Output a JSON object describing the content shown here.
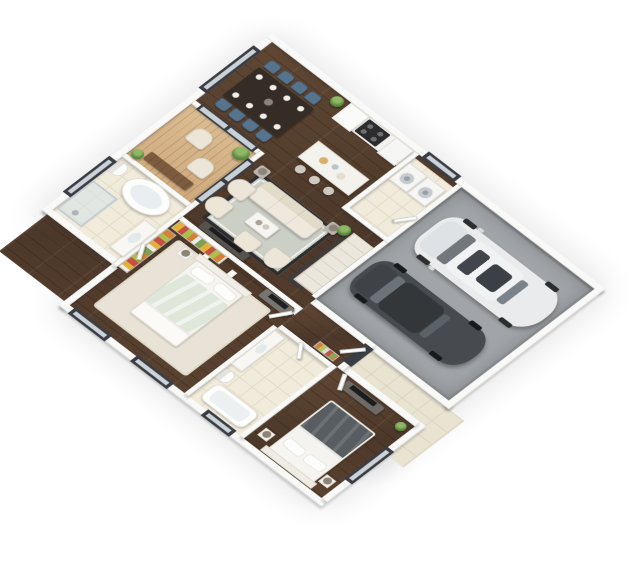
{
  "scene": {
    "type": "isometric-3d-floor-plan",
    "background_color": "#ffffff",
    "rooms": {
      "dining": {
        "name": "Dining area",
        "floor": "dark hardwood",
        "items": [
          "dark rectangular dining table",
          "8 blue upholstered chairs",
          "white place settings",
          "potted plant"
        ]
      },
      "kitchen": {
        "name": "Kitchen",
        "floor": "dark hardwood",
        "items": [
          "white wall counter",
          "black cooktop range",
          "refrigerator",
          "tall cabinet",
          "island with stone top",
          "3 bar stools"
        ]
      },
      "laundry": {
        "name": "Laundry room",
        "floor": "cream tile",
        "items": [
          "washer",
          "dryer"
        ]
      },
      "garage": {
        "name": "Two-car garage",
        "floor": "gray concrete",
        "items": [
          "white SUV",
          "dark gray sedan"
        ]
      },
      "deck": {
        "name": "Wood deck",
        "floor": "light wood planks",
        "items": [
          "2 lounge chairs",
          "low wooden table",
          "2 potted plants"
        ]
      },
      "living": {
        "name": "Living room",
        "floor": "dark hardwood",
        "items": [
          "cream three-seat sofa",
          "2 cream armchairs",
          "2 barrel chairs",
          "white coffee table",
          "2 side tables with lamps",
          "media console with TV",
          "bordered area rug",
          "floor plant"
        ]
      },
      "stairs": {
        "name": "Staircase",
        "items": [
          "light treads",
          "dark handrail"
        ]
      },
      "master_bathroom": {
        "name": "Master bathroom",
        "floor": "cream tile",
        "items": [
          "freestanding oval tub",
          "glass shower",
          "toilet",
          "vanity with sink"
        ]
      },
      "walk_in_closet": {
        "name": "Walk-in closet",
        "items": [
          "colorful hanging clothes racks",
          "white wardrobe partitions"
        ]
      },
      "master_bedroom": {
        "name": "Master bedroom",
        "floor": "dark hardwood",
        "items": [
          "bed with sage green duvet",
          "2 white pillows",
          "nightstand with lamp",
          "dresser with TV",
          "light area rug"
        ]
      },
      "hallway": {
        "name": "Hallway",
        "floor": "dark hardwood",
        "items": [
          "linen shelf with colorful towels",
          "white interior doors"
        ]
      },
      "bathroom_2": {
        "name": "Second bathroom",
        "floor": "cream tile",
        "items": [
          "vanity with sink",
          "toilet",
          "bathtub"
        ]
      },
      "bedroom_2": {
        "name": "Second bedroom",
        "floor": "dark hardwood",
        "items": [
          "bed with dark gray duvet",
          "2 white pillows",
          "2 white nightstands",
          "dresser with TV",
          "potted plant"
        ]
      },
      "porch": {
        "name": "Entry porch",
        "floor": "light tile walkway",
        "items": [
          "front door with dark frame"
        ]
      }
    },
    "vehicles": [
      {
        "name": "white SUV",
        "color": "#e9ebed",
        "position": "garage bay nearest rear wall"
      },
      {
        "name": "dark gray sedan",
        "color": "#474b4f",
        "position": "garage bay nearest entry"
      }
    ],
    "palette": {
      "wall": "#f9f9f8",
      "hardwood_dark": "#54402f",
      "deck_wood": "#d3b28a",
      "tile_cream": "#f1ebdc",
      "concrete_gray": "#a1a4a8",
      "rug_sage_gray": "#cbcfc6",
      "sofa_cream": "#ece6d9",
      "chair_blue": "#57748f",
      "duvet_sage": "#dee7da",
      "duvet_charcoal": "#585d62",
      "window_frame": "#3a3e44",
      "plant_green": "#5d8a42",
      "railing_dark": "#3d3d3f"
    }
  }
}
